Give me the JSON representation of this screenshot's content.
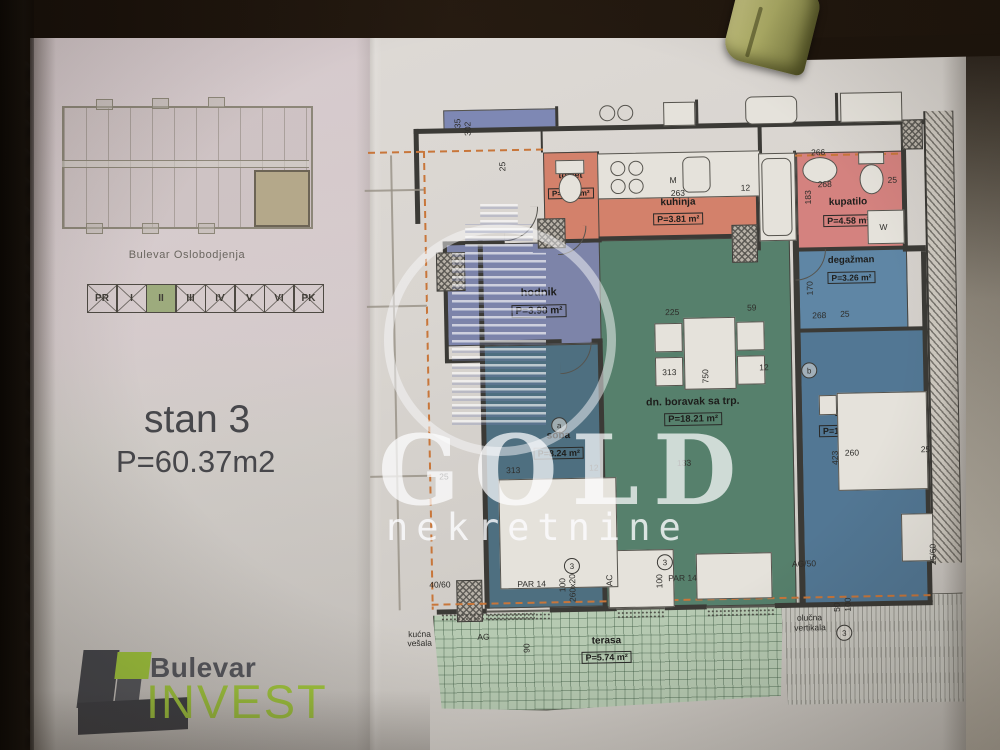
{
  "left_panel": {
    "building_caption": "Bulevar Oslobodjenja",
    "floors": [
      "PR",
      "I",
      "II",
      "III",
      "IV",
      "V",
      "VI",
      "PK"
    ],
    "selected_floor": "II",
    "unit_title": "stan 3",
    "unit_area": "P=60.37m2",
    "logo": {
      "line1": "Bulevar",
      "line2": "INVEST"
    }
  },
  "watermark": {
    "title": "GOLD",
    "subtitle": "nekretnine",
    "emblem_icon": "building-in-ring"
  },
  "plan": {
    "rooms": [
      {
        "id": "toalet",
        "name": "toalet",
        "area": "P=1.54 m²"
      },
      {
        "id": "kuhinja",
        "name": "kuhinja",
        "area": "P=3.81 m²"
      },
      {
        "id": "kupatilo",
        "name": "kupatilo",
        "area": "P=4.58 m²"
      },
      {
        "id": "degazman",
        "name": "degažman",
        "area": "P=3.26 m²"
      },
      {
        "id": "hodnik",
        "name": "hodnik",
        "area": "P=3.98 m²"
      },
      {
        "id": "soba-1",
        "name": "soba",
        "area": "P=8.24 m²"
      },
      {
        "id": "boravak",
        "name": "dn. boravak sa trp.",
        "area": "P=18.21 m²"
      },
      {
        "id": "soba-2",
        "name": "soba",
        "area": "P=11.01 m²"
      },
      {
        "id": "terasa",
        "name": "terasa",
        "area": "P=5.74 m²"
      }
    ],
    "dims": [
      {
        "t": "35",
        "x": 457,
        "y": 124,
        "v": true
      },
      {
        "t": "302",
        "x": 467,
        "y": 132,
        "v": true
      },
      {
        "t": "25",
        "x": 501,
        "y": 168,
        "v": true
      },
      {
        "t": "M",
        "x": 673,
        "y": 175
      },
      {
        "t": "263",
        "x": 674,
        "y": 188
      },
      {
        "t": "12",
        "x": 744,
        "y": 184
      },
      {
        "t": "266",
        "x": 815,
        "y": 150
      },
      {
        "t": "268",
        "x": 821,
        "y": 182
      },
      {
        "t": "25",
        "x": 891,
        "y": 179
      },
      {
        "t": "183",
        "x": 806,
        "y": 207,
        "v": true
      },
      {
        "t": "W",
        "x": 882,
        "y": 226
      },
      {
        "t": "268",
        "x": 813,
        "y": 313
      },
      {
        "t": "25",
        "x": 841,
        "y": 312
      },
      {
        "t": "170",
        "x": 806,
        "y": 298,
        "v": true
      },
      {
        "t": "225",
        "x": 666,
        "y": 307
      },
      {
        "t": "59",
        "x": 748,
        "y": 304
      },
      {
        "t": "313",
        "x": 662,
        "y": 367
      },
      {
        "t": "750",
        "x": 700,
        "y": 384,
        "v": true
      },
      {
        "t": "12",
        "x": 759,
        "y": 364
      },
      {
        "t": "313",
        "x": 504,
        "y": 462
      },
      {
        "t": "12",
        "x": 587,
        "y": 461
      },
      {
        "t": "133",
        "x": 675,
        "y": 458
      },
      {
        "t": "423",
        "x": 828,
        "y": 468,
        "v": true
      },
      {
        "t": "260",
        "x": 843,
        "y": 451
      },
      {
        "t": "25",
        "x": 919,
        "y": 449
      },
      {
        "t": "25",
        "x": 437,
        "y": 467
      },
      {
        "t": "40/60",
        "x": 425,
        "y": 575
      },
      {
        "t": "PAR 14",
        "x": 513,
        "y": 576
      },
      {
        "t": "100",
        "x": 553,
        "y": 590,
        "v": true
      },
      {
        "t": "260x20",
        "x": 563,
        "y": 600,
        "v": true
      },
      {
        "t": "AC",
        "x": 600,
        "y": 585,
        "v": true
      },
      {
        "t": "AG",
        "x": 472,
        "y": 628
      },
      {
        "t": "90",
        "x": 516,
        "y": 650,
        "v": true
      },
      {
        "t": "100",
        "x": 650,
        "y": 588,
        "v": true
      },
      {
        "t": "PAR 14",
        "x": 664,
        "y": 573
      },
      {
        "t": "AG/50",
        "x": 788,
        "y": 561
      },
      {
        "t": "25/60",
        "x": 924,
        "y": 570,
        "v": true
      },
      {
        "t": "50",
        "x": 827,
        "y": 615,
        "v": true
      },
      {
        "t": "100",
        "x": 838,
        "y": 615,
        "v": true
      },
      {
        "t": "kućna",
        "x": 403,
        "y": 624
      },
      {
        "t": "vešala",
        "x": 402,
        "y": 633
      },
      {
        "t": "olučna",
        "x": 792,
        "y": 615
      },
      {
        "t": "vertikala",
        "x": 789,
        "y": 625
      }
    ],
    "bubbles": [
      {
        "t": "3",
        "x": 560,
        "y": 556
      },
      {
        "t": "3",
        "x": 653,
        "y": 554
      },
      {
        "t": "3",
        "x": 831,
        "y": 628
      },
      {
        "t": "a",
        "x": 550,
        "y": 415
      },
      {
        "t": "b",
        "x": 801,
        "y": 365
      }
    ]
  }
}
